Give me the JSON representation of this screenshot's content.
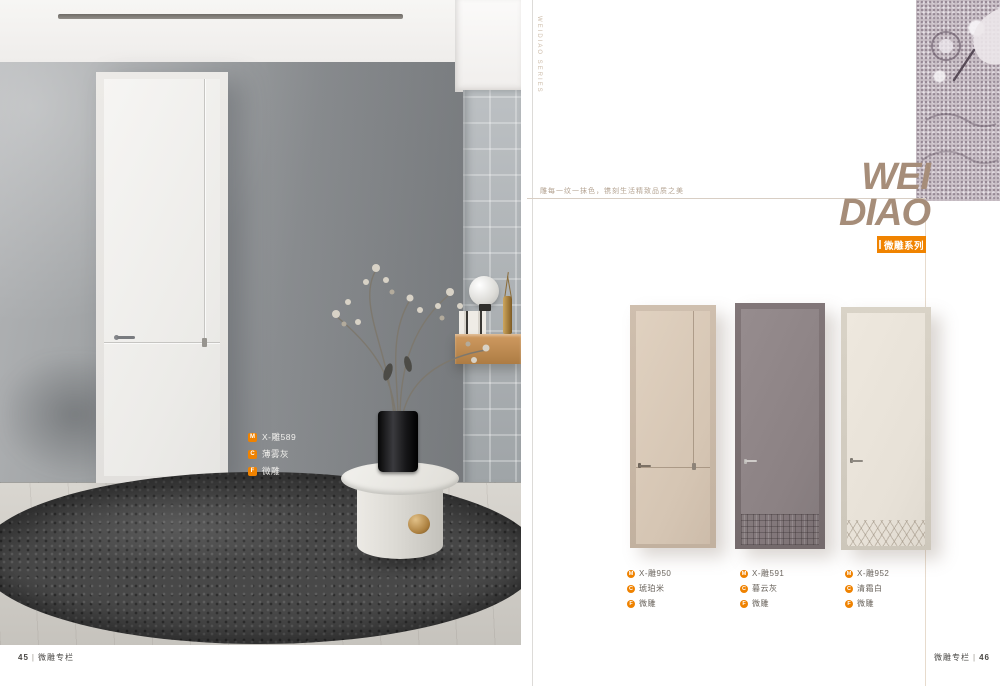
{
  "catalog": {
    "accent_color": "#f08300",
    "title_color": "#a68d79"
  },
  "left_page": {
    "room_label": {
      "model_icon": "M",
      "model": "X-雕589",
      "color_icon": "C",
      "color_name": "薄雾灰",
      "craft_icon": "F",
      "craft": "微雕"
    },
    "footer": {
      "page_number": "45",
      "separator": "|",
      "label": "微雕专栏"
    }
  },
  "right_page": {
    "vertical_caption": "WEIDIAO SERIES",
    "tagline": "雕每一纹一抹色，镌刻生活精致品质之美",
    "title": {
      "line1": "WEI",
      "line2": "DIAO"
    },
    "series_badge": "微雕系列",
    "label_icons": {
      "model": "M",
      "color": "C",
      "craft": "F"
    },
    "doors": [
      {
        "model": "X-雕950",
        "color_name": "琥珀米",
        "craft": "微雕",
        "finish_hex": "#d9c9b8"
      },
      {
        "model": "X-雕591",
        "color_name": "暮云灰",
        "craft": "微雕",
        "finish_hex": "#8f8486"
      },
      {
        "model": "X-雕952",
        "color_name": "清霜白",
        "craft": "微雕",
        "finish_hex": "#eae4da"
      }
    ],
    "footer": {
      "label": "微雕专栏",
      "separator": "|",
      "page_number": "46"
    }
  }
}
